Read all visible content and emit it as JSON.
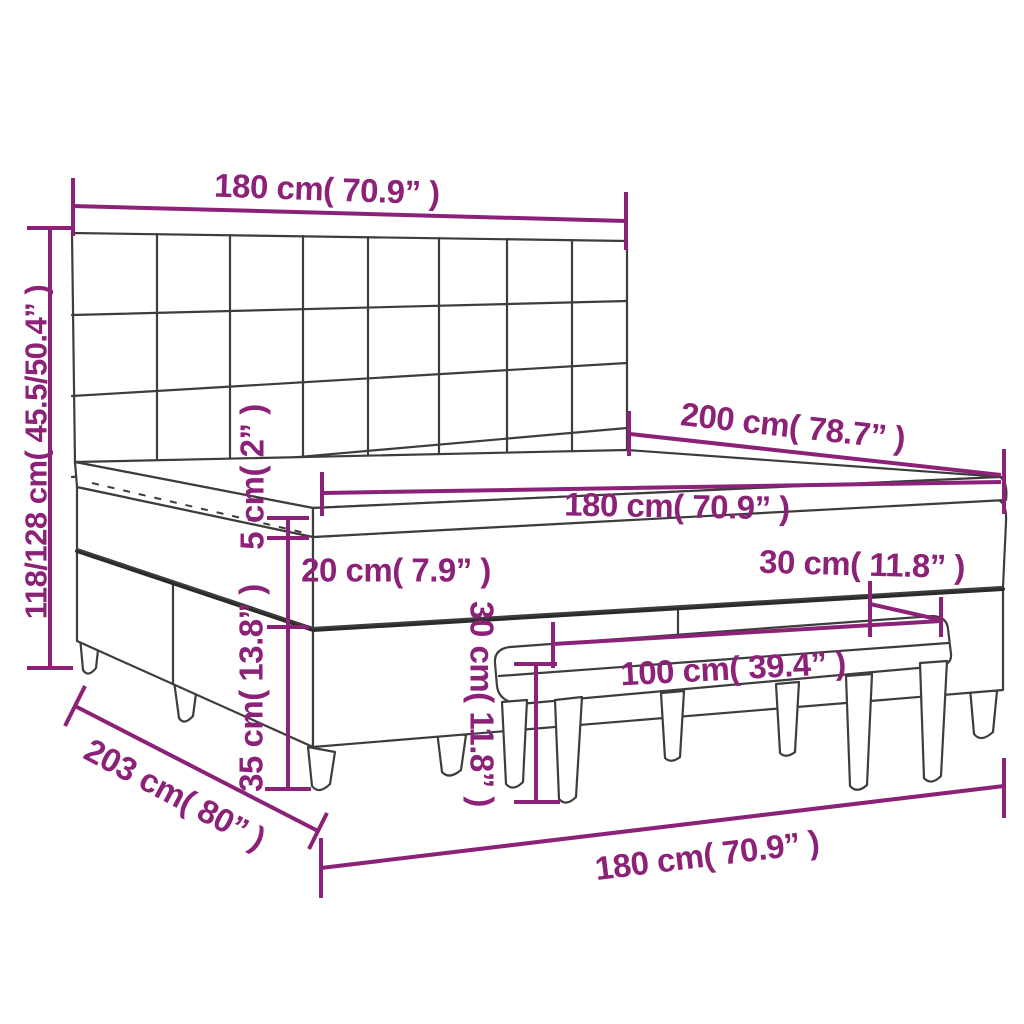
{
  "diagram": {
    "subject": "box-spring-bed-with-headboard-mattress-topper-and-bench",
    "background": "#ffffff",
    "colors": {
      "dimension_accent": "#8C2277",
      "outline": "#3d3d3d",
      "dark_edge": "#2b2b2b"
    },
    "headboard": {
      "columns": 8,
      "rows": 4
    },
    "labels": {
      "headboard_width": "180 cm( 70.9” )",
      "total_height": "118/128 cm( 45.5/50.4” )",
      "bed_length": "200 cm( 78.7” )",
      "mattress_width": "180 cm( 70.9” )",
      "topper_thickness": "5 cm( 2” )",
      "mattress_thickness": "20 cm( 7.9” )",
      "base_height": "35 cm( 13.8” )",
      "bench_height": "30 cm( 11.8” )",
      "bench_depth": "30 cm( 11.8” )",
      "bench_length": "100 cm( 39.4” )",
      "overall_length": "203 cm( 80” )",
      "overall_width": "180 cm( 70.9” )"
    }
  }
}
